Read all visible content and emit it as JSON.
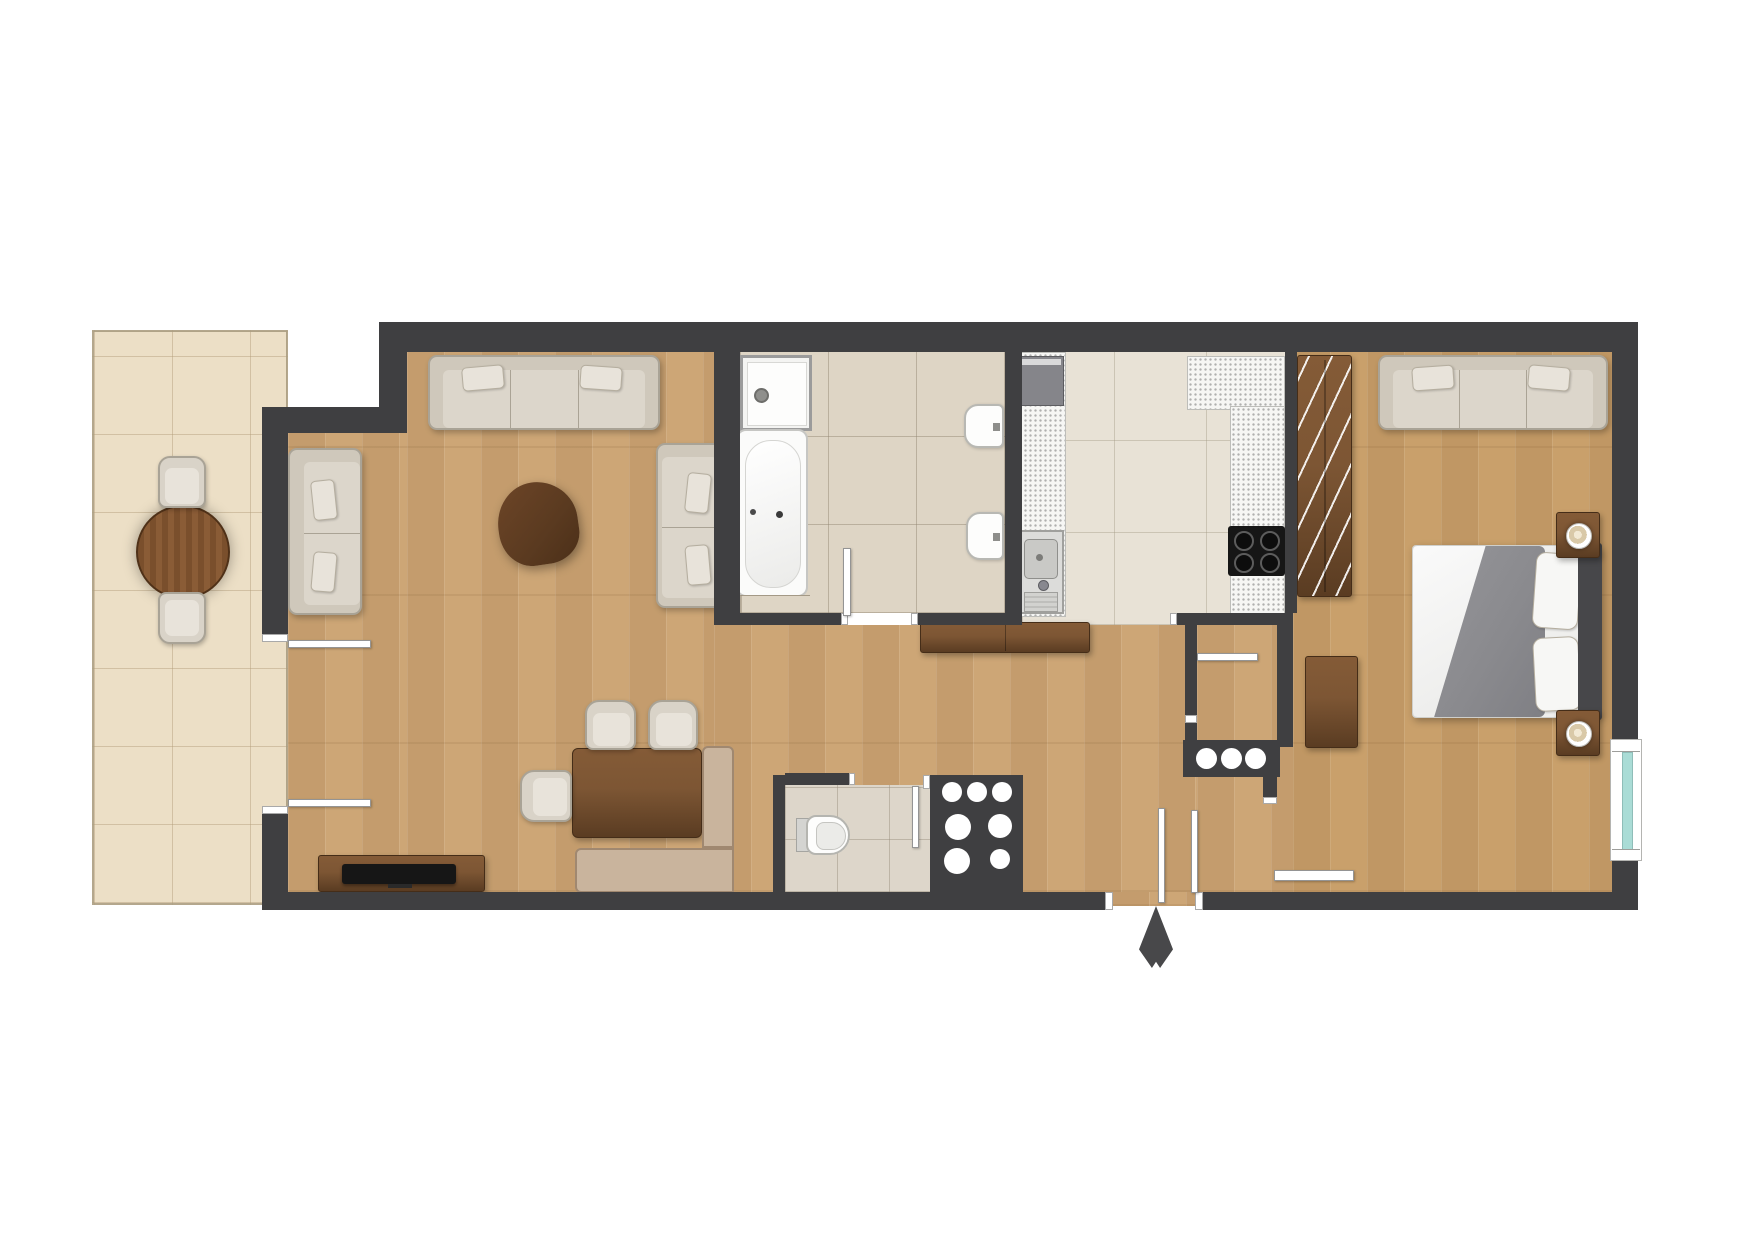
{
  "plan": {
    "kind": "apartment-floor-plan-top-view",
    "canvas": {
      "width": 1754,
      "height": 1240
    }
  },
  "colors": {
    "background": "#ffffff",
    "wall": "#3f3f41",
    "wood_floor": "#cda676",
    "wood_floor_bedroom": "#c9a06b",
    "terrace_tile": "#ecdfc6",
    "bathroom_tile": "#ded5c5",
    "kitchen_tile": "#e8e2d6",
    "wc_tile": "#ddd6ca",
    "counter_speckle": "#f6f6f4",
    "furniture_beige": "#d9d3c8",
    "furniture_beige_border": "#a9a396",
    "bench_tan": "#c9b49d",
    "walnut_wood": "#7d5634",
    "walnut_wood_dark": "#5a3c22",
    "appliance_black": "#161616",
    "appliance_steel": "#d7d7d7",
    "bed_linen": "#efefed",
    "duvet_gray": "#8e8e92",
    "window_glass": "#aadcd6",
    "door_leaf": "#ffffff",
    "entrance_arrow": "#48484a"
  },
  "rooms": [
    {
      "id": "terrace",
      "label": "terrace"
    },
    {
      "id": "living-dining",
      "label": "living-dining-area"
    },
    {
      "id": "bathroom",
      "label": "bathroom"
    },
    {
      "id": "kitchen",
      "label": "kitchen"
    },
    {
      "id": "wc",
      "label": "wc"
    },
    {
      "id": "hallway",
      "label": "entrance-hallway"
    },
    {
      "id": "closet",
      "label": "closet"
    },
    {
      "id": "bedroom",
      "label": "bedroom"
    }
  ],
  "furniture": {
    "terrace": [
      "round-table",
      "chair",
      "chair"
    ],
    "living_dining": [
      "three-seat-sofa",
      "two-seat-sofa-left",
      "two-seat-sofa-right",
      "organic-coffee-table",
      "tv-stand",
      "tv",
      "dining-table",
      "dining-chair",
      "dining-chair",
      "dining-chair",
      "corner-bench"
    ],
    "bathroom": [
      "shower-tray",
      "bathtub",
      "washbasin",
      "bidet"
    ],
    "kitchen": [
      "fridge",
      "countertop-left",
      "sink",
      "countertop-right",
      "cooktop",
      "sideboard"
    ],
    "wc": [
      "toilet"
    ],
    "bedroom": [
      "wardrobe",
      "sofa",
      "double-bed",
      "pillow",
      "pillow",
      "nightstand",
      "nightstand",
      "table-lamp",
      "table-lamp",
      "desk"
    ]
  },
  "openings": {
    "entrance": "entrance-door-bottom-wall",
    "terrace_doors": [
      "terrace-sliding-door-upper",
      "terrace-sliding-door-lower"
    ],
    "interior_doors": [
      "bathroom-door",
      "wc-door",
      "closet-door",
      "bedroom-sliding-door"
    ],
    "windows": [
      "bedroom-window-right-wall"
    ]
  },
  "symbols": {
    "entrance_arrow": "entrance-direction-arrow"
  }
}
